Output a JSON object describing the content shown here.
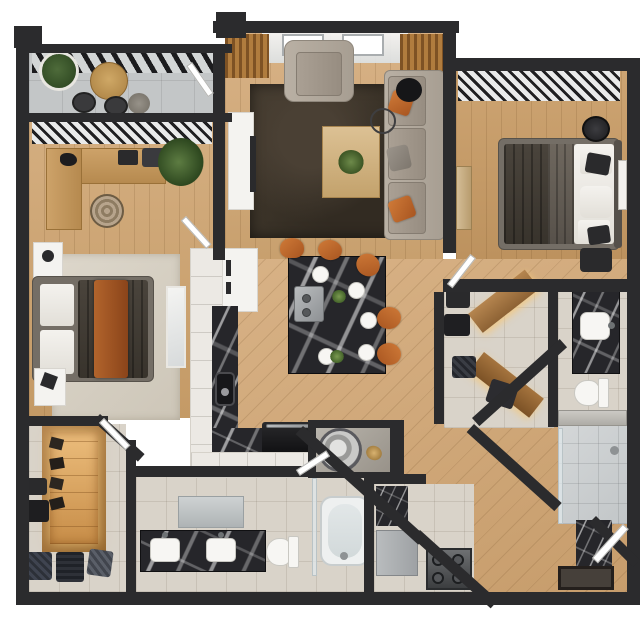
{
  "meta": {
    "title": "3D Apartment Floor Plan",
    "description": "Top-down 3D rendered floor plan of a two-bedroom, two-bathroom apartment with balcony, open living/dining area, walk-in closets, laundry and utility rooms",
    "background": "#ffffff"
  },
  "palette": {
    "wall": "#2b2b2d",
    "wood_hi": "#d4ae80",
    "wood_lo": "#c49a66",
    "tile": "#d9d3c9",
    "concrete": "#c3c6c7",
    "marble": "#26262a",
    "cabinet": "#ece9e4",
    "rug_dark": "#3b332a",
    "rug_light": "#d9d3c7",
    "sofa_gray": "#aaa196",
    "accent_orange": "#bc6a31",
    "closet_wood": "#b07c46",
    "closet_glow": "#f3c87e",
    "fixture_white": "#f6f5f2",
    "glass": "#dfe7ea"
  },
  "rooms": [
    {
      "id": "balcony",
      "name": "Balcony",
      "furniture": [
        "slatted pergola",
        "round wood table",
        "two dark chairs",
        "gray stool",
        "potted plant"
      ]
    },
    {
      "id": "bedroom-1",
      "name": "Bedroom 1 with Office Nook",
      "furniture": [
        "L-shaped desk",
        "desk lamp",
        "round desk chair",
        "palm plant",
        "white nightstands",
        "queen bed with dark duvet and rust throw",
        "light area rug",
        "leaning mirror",
        "window blinds"
      ]
    },
    {
      "id": "living-room",
      "name": "Living Room",
      "furniture": [
        "gray armchair",
        "gray sectional sofa",
        "orange accent pillows",
        "wood coffee table with plant",
        "round floor lamp",
        "white tv console",
        "wood curtains",
        "sheer curtains",
        "dark brown rug"
      ]
    },
    {
      "id": "bedroom-2",
      "name": "Bedroom 2",
      "furniture": [
        "queen bed with dark duvet",
        "white pillows",
        "round nightstand",
        "black nightstand",
        "wood bench",
        "wall art",
        "window blinds"
      ]
    },
    {
      "id": "kitchen",
      "name": "Kitchen",
      "furniture": [
        "tall fridge cabinet",
        "white L-shaped cabinets",
        "black marble countertop",
        "undermount sink",
        "black oven appliance"
      ]
    },
    {
      "id": "dining-island",
      "name": "Dining Island",
      "furniture": [
        "black marble island",
        "built-in cooktop",
        "five white place settings",
        "greenery",
        "five rust-orange chairs"
      ]
    },
    {
      "id": "walk-in-closet",
      "name": "Walk-in Closet",
      "furniture": [
        "illuminated wood wardrobe",
        "hanging clothes",
        "wall hooks",
        "storage baskets"
      ]
    },
    {
      "id": "bathroom-1",
      "name": "Main Bathroom",
      "furniture": [
        "double marble vanity",
        "two white sinks",
        "wall mirror",
        "toilet",
        "bathtub",
        "glass panel"
      ]
    },
    {
      "id": "laundry",
      "name": "Laundry Nook",
      "furniture": [
        "round drum washer",
        "brass fixture"
      ]
    },
    {
      "id": "utility",
      "name": "Utility Room",
      "furniture": [
        "marble wall panel",
        "gray cabinet",
        "four-burner range"
      ]
    },
    {
      "id": "entry-closet",
      "name": "Entry Closet",
      "furniture": [
        "angled lit wood shelves",
        "storage boxes",
        "wall panels"
      ]
    },
    {
      "id": "bathroom-2",
      "name": "Second Bathroom",
      "furniture": [
        "marble vanity",
        "white vessel sink",
        "toilet",
        "walk-in glass shower",
        "bench counter"
      ]
    },
    {
      "id": "entry",
      "name": "Entry Hall",
      "furniture": [
        "dark doormat",
        "marble panel",
        "entry door"
      ]
    }
  ]
}
